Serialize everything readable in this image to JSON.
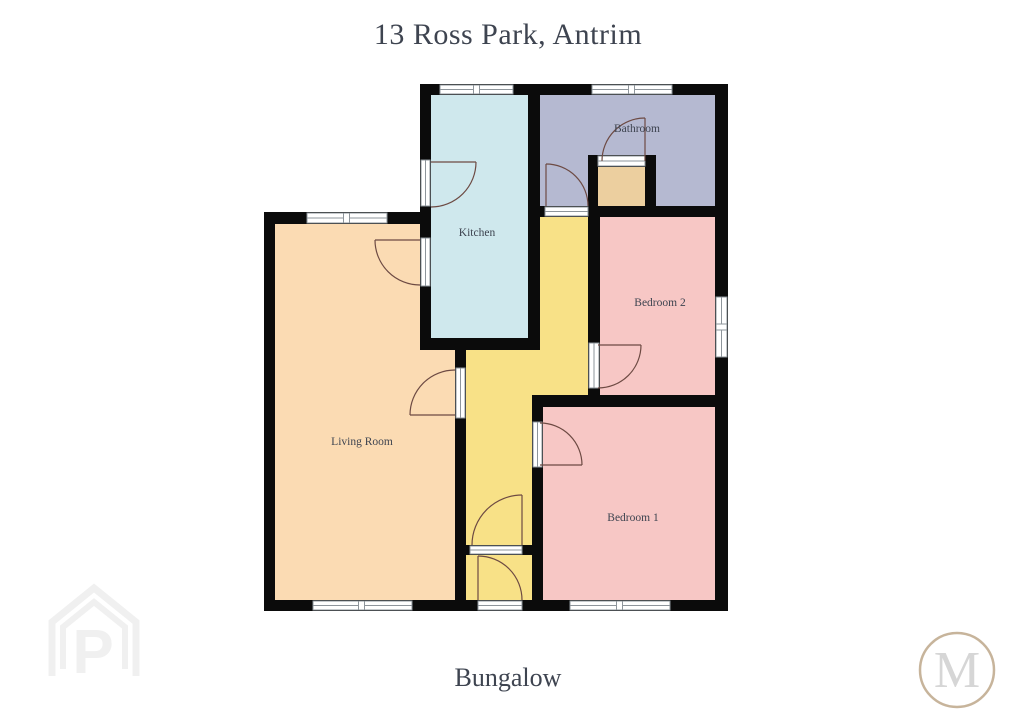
{
  "page": {
    "title": "13 Ross Park, Antrim",
    "property_type": "Bungalow"
  },
  "rooms": {
    "kitchen": {
      "label": "Kitchen",
      "color": "#cfe8ed"
    },
    "bathroom": {
      "label": "Bathroom",
      "color": "#b5b9d1"
    },
    "hot_press": {
      "color": "#eccf9f"
    },
    "hall": {
      "color": "#f8e187"
    },
    "bedroom2": {
      "label": "Bedroom 2",
      "color": "#f7c7c5"
    },
    "bedroom1": {
      "label": "Bedroom 1",
      "color": "#f7c7c5"
    },
    "living_room": {
      "label": "Living Room",
      "color": "#fbdbb3"
    }
  },
  "colors": {
    "wall": "#0b0b0b",
    "text": "#3e4450",
    "door_arc": "#6d4a43",
    "window_frame": "#8e959b",
    "watermark_house": "#f0f0f0",
    "watermark_ring": "#c7b49b",
    "watermark_letter": "#d6d6d6"
  },
  "watermarks": {
    "house_letter": "P",
    "circle_letter": "M"
  }
}
